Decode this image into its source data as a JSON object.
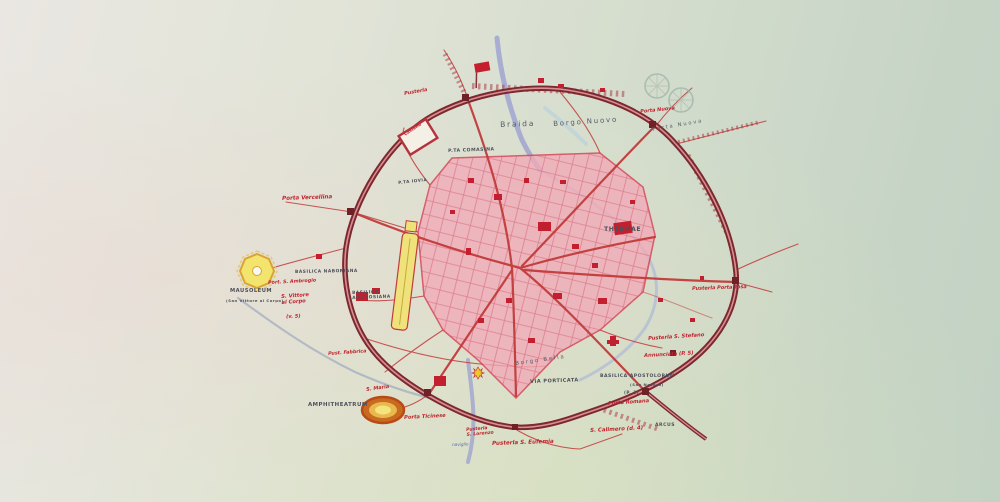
{
  "page": {
    "width": 1000,
    "height": 502
  },
  "map": {
    "colors": {
      "wall": "#7b2830",
      "wall_inner": "#d98f8f",
      "road_red": "#c23b3b",
      "core_fill": "#f2aab8",
      "core_stroke": "#d63a50",
      "water": "#9fa6cf",
      "label_red": "#c0242f",
      "label_dark": "#4d4f5a",
      "yellow_feature": "#f1e06e",
      "amphitheatre_ring": "#b84a16",
      "building_red": "#c2202e",
      "watermark": "#9db3a7"
    },
    "features": [
      "city-wall",
      "roman-core",
      "street-grid",
      "rivers",
      "mausoleum",
      "amphitheatrum",
      "circus",
      "thermae-building",
      "castello-box",
      "red-flag",
      "watermark-seal",
      "gates",
      "san-lorenzo-star"
    ],
    "labels": [
      {
        "id": "pusterla-north-west",
        "text": "Pusterla",
        "style": "red",
        "x": 404,
        "y": 92,
        "size": 5,
        "rot": -10
      },
      {
        "id": "castello",
        "text": "Castello",
        "style": "red",
        "x": 404,
        "y": 134,
        "size": 4.3,
        "rot": -33
      },
      {
        "id": "porta-comasina",
        "text": "P.TA COMASINA",
        "style": "dark",
        "x": 448,
        "y": 149,
        "size": 4.6,
        "rot": -2
      },
      {
        "id": "braida",
        "text": "Braida",
        "style": "hand",
        "x": 500,
        "y": 121,
        "size": 7.5,
        "rot": -2
      },
      {
        "id": "borgo-nuovo",
        "text": "Borgo Nuovo",
        "style": "hand",
        "x": 553,
        "y": 121,
        "size": 7,
        "rot": -4
      },
      {
        "id": "porta-nuova",
        "text": "Porta Nuova",
        "style": "red",
        "x": 640,
        "y": 110,
        "size": 5,
        "rot": -6
      },
      {
        "id": "borgo-porta-nuova",
        "text": "Porta Nuova",
        "style": "hand",
        "x": 652,
        "y": 128,
        "size": 5.2,
        "rot": -10
      },
      {
        "id": "thermae",
        "text": "THERMAE",
        "style": "dark",
        "x": 604,
        "y": 227,
        "size": 6.2,
        "rot": 0
      },
      {
        "id": "porta-vercellina",
        "text": "Porta Vercellina",
        "style": "red",
        "x": 282,
        "y": 196,
        "size": 5.6,
        "rot": -2
      },
      {
        "id": "basilica-naboriana",
        "text": "BASILICA NABORIANA",
        "style": "dark",
        "x": 295,
        "y": 271,
        "size": 4.4,
        "rot": -1
      },
      {
        "id": "port-s-ambrogio",
        "text": "Port. S. Ambrogio",
        "style": "red",
        "x": 268,
        "y": 281,
        "size": 4.8,
        "rot": -3
      },
      {
        "id": "mausoleum",
        "text": "MAUSOLEUM",
        "style": "dark",
        "x": 230,
        "y": 289,
        "size": 5.2,
        "rot": 0
      },
      {
        "id": "mausoleum-note",
        "text": "(San Vittore al Corpo)",
        "style": "dark",
        "x": 226,
        "y": 299,
        "size": 3.8,
        "rot": 0
      },
      {
        "id": "s-vittore-al-corpo",
        "text": "S. Vittore\nal Corpo",
        "style": "red",
        "x": 281,
        "y": 295,
        "size": 5.2,
        "rot": -4
      },
      {
        "id": "s-vittore-ref",
        "text": "(v. 5)",
        "style": "red",
        "x": 286,
        "y": 315,
        "size": 5,
        "rot": -2
      },
      {
        "id": "basilica-ambrosiana",
        "text": "BASILICA\nAMBROSIANA",
        "style": "dark",
        "x": 352,
        "y": 292,
        "size": 4.4,
        "rot": -2
      },
      {
        "id": "porta-iovia",
        "text": "P.TA IOVIA",
        "style": "dark",
        "x": 398,
        "y": 181,
        "size": 4.2,
        "rot": -6
      },
      {
        "id": "pusterla-fabbrica",
        "text": "Pust. Fabbrica",
        "style": "red",
        "x": 328,
        "y": 352,
        "size": 4.8,
        "rot": -4
      },
      {
        "id": "amphitheatrum",
        "text": "AMPHITHEATRUM",
        "style": "dark",
        "x": 308,
        "y": 402,
        "size": 5.4,
        "rot": 0
      },
      {
        "id": "s-maria",
        "text": "S. Maria",
        "style": "red",
        "x": 366,
        "y": 388,
        "size": 5,
        "rot": -8
      },
      {
        "id": "porta-ticinese",
        "text": "Porta Ticinese",
        "style": "red",
        "x": 404,
        "y": 416,
        "size": 5.2,
        "rot": -3
      },
      {
        "id": "pusterla-s-lorenzo",
        "text": "Pusterla\nS. Lorenzo",
        "style": "red",
        "x": 466,
        "y": 428,
        "size": 4.6,
        "rot": -5
      },
      {
        "id": "naviglio",
        "text": "naviglio",
        "style": "blue",
        "x": 452,
        "y": 443,
        "size": 4.2,
        "rot": -2
      },
      {
        "id": "pusterla-s-eufemia",
        "text": "Pusterla S. Eufemia",
        "style": "red",
        "x": 492,
        "y": 441,
        "size": 5.6,
        "rot": -2
      },
      {
        "id": "via-porticata",
        "text": "VIA PORTICATA",
        "style": "dark",
        "x": 530,
        "y": 380,
        "size": 5,
        "rot": -2
      },
      {
        "id": "borgo-bella",
        "text": "Borgo Bella",
        "style": "hand",
        "x": 515,
        "y": 361,
        "size": 5.4,
        "rot": -8
      },
      {
        "id": "basilica-apostolorum",
        "text": "BASILICA APOSTOLORUM",
        "style": "dark",
        "x": 600,
        "y": 374,
        "size": 4.6,
        "rot": 0
      },
      {
        "id": "san-nazaro-note",
        "text": "(San Nazaro)",
        "style": "dark",
        "x": 630,
        "y": 383,
        "size": 3.8,
        "rot": 0
      },
      {
        "id": "apostolorum-ref",
        "text": "(P. 3)",
        "style": "dark",
        "x": 624,
        "y": 391,
        "size": 4.2,
        "rot": 0
      },
      {
        "id": "porta-romana",
        "text": "Porta Romana",
        "style": "red",
        "x": 608,
        "y": 402,
        "size": 5.2,
        "rot": -4
      },
      {
        "id": "s-calimero",
        "text": "S. Calimero (d. 4)",
        "style": "red",
        "x": 590,
        "y": 428,
        "size": 5.4,
        "rot": -3
      },
      {
        "id": "arcus",
        "text": "ARCUS",
        "style": "dark",
        "x": 655,
        "y": 423,
        "size": 4.6,
        "rot": 0
      },
      {
        "id": "pusterla-s-stefano",
        "text": "Pusterla S. Stefano",
        "style": "red",
        "x": 648,
        "y": 337,
        "size": 5.2,
        "rot": -4
      },
      {
        "id": "annunciata",
        "text": "Annunciata (P. 5)",
        "style": "red",
        "x": 644,
        "y": 354,
        "size": 5.2,
        "rot": -3
      },
      {
        "id": "porta-tosa",
        "text": "Pusterla Porta Tosa",
        "style": "red",
        "x": 692,
        "y": 287,
        "size": 5,
        "rot": -2
      }
    ]
  }
}
